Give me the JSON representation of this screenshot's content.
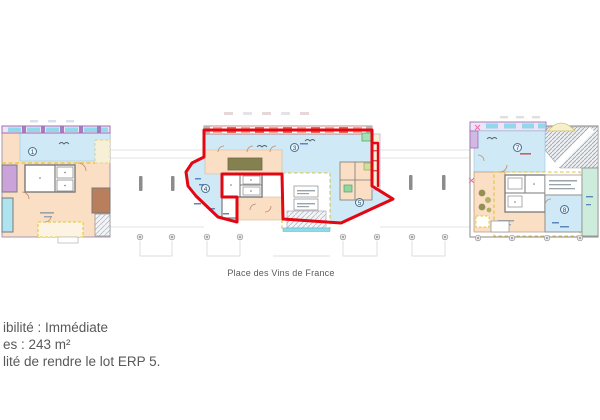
{
  "plan": {
    "street_label": "Place des Vins de France",
    "zones": [
      {
        "label": "1"
      },
      {
        "label": "3"
      },
      {
        "label": "4"
      },
      {
        "label": "5"
      },
      {
        "label": "7"
      },
      {
        "label": "8"
      }
    ]
  },
  "notes": [
    {
      "text": "ibilité : Immédiate"
    },
    {
      "text": "es : 243 m²"
    },
    {
      "text": "lité de rendre le lot ERP 5."
    }
  ],
  "colors": {
    "lot_outline_red": "#e30613",
    "zone_blue": "#cfe9f6",
    "zone_peach": "#fadfc4",
    "zone_cyan": "#8fd9ea",
    "zone_purple": "#c9a3d9",
    "zone_brown": "#b97f5c",
    "zone_olive": "#85804f",
    "zone_green": "#cdecdc",
    "wall_gray": "#7a7a7a",
    "dashed_yellow": "#e3c430",
    "note_text_gray": "#595959"
  }
}
